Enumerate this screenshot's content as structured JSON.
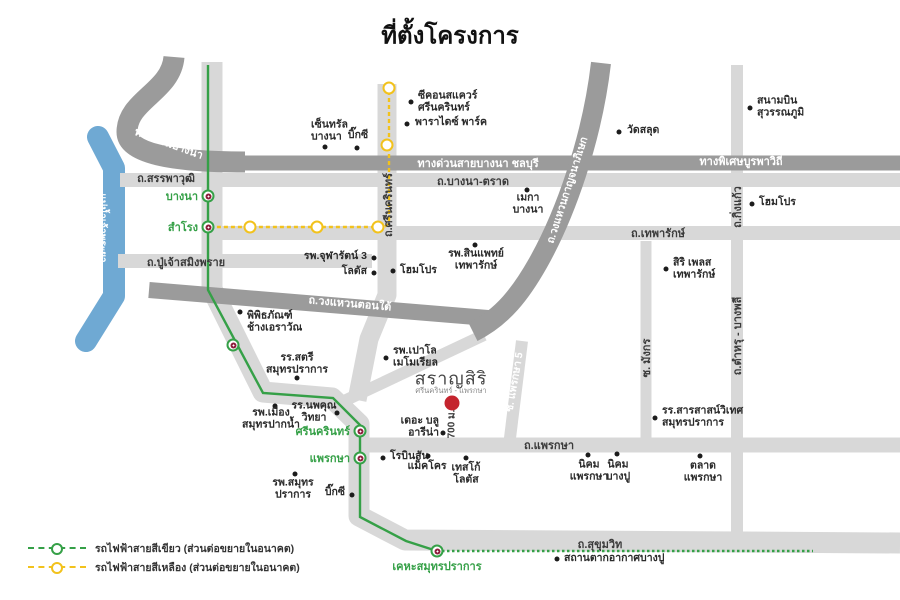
{
  "title": "ที่ตั้งโครงการ",
  "colors": {
    "road_dark": "#9b9b9b",
    "road_light": "#d8d8d8",
    "river": "#6fa9d3",
    "green_line": "#35a047",
    "yellow_line": "#f2c21c",
    "station_logo": "#8e1f3d",
    "marker_red": "#c4242e"
  },
  "project": {
    "name": "สราญสิริ",
    "subtitle": "ศรีนครินทร์ - แพรกษา",
    "distance_label": "700 ม."
  },
  "river_label": "แม่น้ำเจ้าพระยา",
  "map_labels": [
    {
      "text": "ทางด่วนบางนา",
      "x": 169,
      "y": 143,
      "rot": 20,
      "color": "white"
    },
    {
      "text": "ถ.สรรพาวุฒิ",
      "x": 166,
      "y": 178,
      "rot": 0,
      "color": "dark"
    },
    {
      "text": "ทางด่วนสายบางนา ชลบุรี",
      "x": 478,
      "y": 163,
      "rot": 0,
      "color": "white"
    },
    {
      "text": "ทางพิเศษบูรพาวิถี",
      "x": 741,
      "y": 161,
      "rot": 0,
      "color": "white"
    },
    {
      "text": "ถ.บางนา-ตราด",
      "x": 473,
      "y": 181,
      "rot": 0,
      "color": "dark"
    },
    {
      "text": "ถ.เทพารักษ์",
      "x": 658,
      "y": 233,
      "rot": 0,
      "color": "dark"
    },
    {
      "text": "ถ.ปู่เจ้าสมิงพราย",
      "x": 186,
      "y": 262,
      "rot": 0,
      "color": "dark"
    },
    {
      "text": "ถ.วงแหวนตอนใต้",
      "x": 350,
      "y": 303,
      "rot": 5,
      "color": "white"
    },
    {
      "text": "ถ.วงแหวนกาญจนาภิเษก",
      "x": 567,
      "y": 190,
      "rot": -72,
      "color": "white",
      "size": 10.5
    },
    {
      "text": "ถ.ศรีนครินทร์",
      "x": 388,
      "y": 205,
      "rot": -90,
      "color": "dark"
    },
    {
      "text": "ถ.กิ่งแก้ว",
      "x": 737,
      "y": 207,
      "rot": -90,
      "color": "dark"
    },
    {
      "text": "ถ.ตำหรุ - บางพลี",
      "x": 737,
      "y": 336,
      "rot": -90,
      "color": "dark"
    },
    {
      "text": "ซ. มังกร",
      "x": 646,
      "y": 358,
      "rot": -90,
      "color": "dark"
    },
    {
      "text": "ซ. แพรกษา 5",
      "x": 514,
      "y": 382,
      "rot": -80,
      "color": "white",
      "size": 10.5
    },
    {
      "text": "ถ.แพรกษา",
      "x": 549,
      "y": 445,
      "rot": 0,
      "color": "dark"
    },
    {
      "text": "ถ.สุขุมวิท",
      "x": 600,
      "y": 544,
      "rot": 0,
      "color": "dark"
    },
    {
      "text": "แม่น้ำเจ้าพระยา",
      "x": 102,
      "y": 228,
      "rot": 90,
      "color": "white",
      "size": 10
    },
    {
      "text": "700 ม.",
      "x": 452,
      "y": 424,
      "rot": -90,
      "color": "dark",
      "size": 10
    }
  ],
  "stations_green": [
    {
      "name": "บางนา",
      "x": 208,
      "y": 196,
      "label_side": "left"
    },
    {
      "name": "สำโรง",
      "x": 208,
      "y": 227,
      "label_side": "left"
    },
    {
      "name": "",
      "x": 233,
      "y": 345,
      "label_side": "none"
    },
    {
      "name": "ศรีนครินทร์",
      "x": 360,
      "y": 431,
      "label_side": "left"
    },
    {
      "name": "แพรกษา",
      "x": 360,
      "y": 458,
      "label_side": "left"
    },
    {
      "name": "เคหะสมุทรปราการ",
      "x": 437,
      "y": 551,
      "label_side": "below"
    }
  ],
  "stations_yellow": [
    {
      "x": 389,
      "y": 88
    },
    {
      "x": 387,
      "y": 145
    },
    {
      "x": 378,
      "y": 227
    },
    {
      "x": 317,
      "y": 227
    },
    {
      "x": 250,
      "y": 227
    }
  ],
  "pois": [
    {
      "id": "central-bangna",
      "lines": [
        "เซ็นทรัล",
        "บางนา"
      ],
      "dot": [
        325,
        147
      ],
      "label": [
        311,
        131
      ],
      "align": "left"
    },
    {
      "id": "bigc-bangna",
      "lines": [
        "บิ๊กซี"
      ],
      "dot": [
        357,
        148
      ],
      "label": [
        358,
        136
      ],
      "align": "center"
    },
    {
      "id": "seacon-square",
      "lines": [
        "ซีคอนสแควร์",
        "ศรีนครินทร์"
      ],
      "dot": [
        411,
        102
      ],
      "label": [
        418,
        102
      ],
      "align": "left"
    },
    {
      "id": "paradise-park",
      "lines": [
        "พาราไดซ์ พาร์ค"
      ],
      "dot": [
        407,
        124
      ],
      "label": [
        415,
        123
      ],
      "align": "left"
    },
    {
      "id": "wat-salud",
      "lines": [
        "วัดสลุด"
      ],
      "dot": [
        619,
        132
      ],
      "label": [
        627,
        131
      ],
      "align": "left"
    },
    {
      "id": "suvarnabhumi-airport",
      "lines": [
        "สนามบิน",
        "สุวรรณภูมิ"
      ],
      "dot": [
        750,
        108
      ],
      "label": [
        757,
        107
      ],
      "align": "left"
    },
    {
      "id": "mega-bangna",
      "lines": [
        "เมกา",
        "บางนา"
      ],
      "dot": [
        527,
        190
      ],
      "label": [
        528,
        204
      ],
      "align": "center"
    },
    {
      "id": "homepro-kingkaew",
      "lines": [
        "โฮมโปร"
      ],
      "dot": [
        752,
        204
      ],
      "label": [
        759,
        203
      ],
      "align": "left"
    },
    {
      "id": "chularat3-hospital",
      "lines": [
        "รพ.จุฬารัตน์ 3"
      ],
      "dot": [
        374,
        258
      ],
      "label": [
        367,
        257
      ],
      "align": "right"
    },
    {
      "id": "lotus",
      "lines": [
        "โลตัส"
      ],
      "dot": [
        374,
        273
      ],
      "label": [
        367,
        272
      ],
      "align": "right"
    },
    {
      "id": "homepro-srinakarin",
      "lines": [
        "โฮมโปร"
      ],
      "dot": [
        393,
        271
      ],
      "label": [
        400,
        271
      ],
      "align": "left"
    },
    {
      "id": "sinphaet-hospital",
      "lines": [
        "รพ.สินแพทย์",
        "เทพารักษ์"
      ],
      "dot": [
        475,
        245
      ],
      "label": [
        476,
        260
      ],
      "align": "center"
    },
    {
      "id": "siri-place",
      "lines": [
        "สิริ เพลส",
        "เทพารักษ์"
      ],
      "dot": [
        666,
        269
      ],
      "label": [
        673,
        269
      ],
      "align": "left"
    },
    {
      "id": "erawan-museum",
      "lines": [
        "พิพิธภัณฑ์",
        "ช้างเอราวัณ"
      ],
      "dot": [
        240,
        312
      ],
      "label": [
        247,
        322
      ],
      "align": "left"
    },
    {
      "id": "satri-school",
      "lines": [
        "รร.สตรี",
        "สมุทรปราการ"
      ],
      "dot": [
        297,
        378
      ],
      "label": [
        297,
        364
      ],
      "align": "center"
    },
    {
      "id": "mueang-paknam-hospital",
      "lines": [
        "รพ.เมือง",
        "สมุทรปากน้ำ"
      ],
      "dot": [
        275,
        406
      ],
      "label": [
        271,
        419
      ],
      "align": "center"
    },
    {
      "id": "noppakhun-school",
      "lines": [
        "รร.นพคุณ",
        "วิทยา"
      ],
      "dot": [
        337,
        413
      ],
      "label": [
        314,
        412
      ],
      "align": "center"
    },
    {
      "id": "paolo-hospital",
      "lines": [
        "รพ.เปาโล",
        "เมโมเรียล"
      ],
      "dot": [
        386,
        358
      ],
      "label": [
        393,
        357
      ],
      "align": "left"
    },
    {
      "id": "blue-arena",
      "lines": [
        "เดอะ บลู",
        "อารีน่า"
      ],
      "dot": [
        443,
        433
      ],
      "label": [
        439,
        427
      ],
      "align": "right"
    },
    {
      "id": "robinson",
      "lines": [
        "โรบินสัน"
      ],
      "dot": [
        383,
        458
      ],
      "label": [
        390,
        457
      ],
      "align": "left"
    },
    {
      "id": "makro",
      "lines": [
        "แม็คโคร"
      ],
      "dot": [
        428,
        456
      ],
      "label": [
        427,
        467
      ],
      "align": "center"
    },
    {
      "id": "tesco-lotus",
      "lines": [
        "เทสโก้",
        "โลตัส"
      ],
      "dot": [
        466,
        458
      ],
      "label": [
        466,
        474
      ],
      "align": "center"
    },
    {
      "id": "nikhom-phraeksa",
      "lines": [
        "นิคม",
        "แพรกษา"
      ],
      "dot": [
        588,
        455
      ],
      "label": [
        589,
        471
      ],
      "align": "center"
    },
    {
      "id": "nikhom-bangpu",
      "lines": [
        "นิคม",
        "บางปู"
      ],
      "dot": [
        617,
        454
      ],
      "label": [
        618,
        471
      ],
      "align": "center"
    },
    {
      "id": "talat-phraeksa",
      "lines": [
        "ตลาด",
        "แพรกษา"
      ],
      "dot": [
        700,
        456
      ],
      "label": [
        703,
        472
      ],
      "align": "center"
    },
    {
      "id": "sarasas-school",
      "lines": [
        "รร.สารสาสน์วิเทศ",
        "สมุทรปราการ"
      ],
      "dot": [
        655,
        418
      ],
      "label": [
        662,
        417
      ],
      "align": "left"
    },
    {
      "id": "bangpu-recreation",
      "lines": [
        "สถานตากอากาศบางปู"
      ],
      "dot": [
        557,
        559
      ],
      "label": [
        564,
        559
      ],
      "align": "left"
    },
    {
      "id": "bigc-south",
      "lines": [
        "บิ๊กซี"
      ],
      "dot": [
        352,
        495
      ],
      "label": [
        345,
        493
      ],
      "align": "right"
    },
    {
      "id": "samutprakan-hospital",
      "lines": [
        "รพ.สมุทร",
        "ปราการ"
      ],
      "dot": [
        295,
        474
      ],
      "label": [
        293,
        489
      ],
      "align": "center"
    }
  ],
  "legend": [
    {
      "type": "green",
      "label": "รถไฟฟ้าสายสีเขียว (ส่วนต่อขยายในอนาคต)"
    },
    {
      "type": "yellow",
      "label": "รถไฟฟ้าสายสีเหลือง (ส่วนต่อขยายในอนาคต)"
    }
  ]
}
